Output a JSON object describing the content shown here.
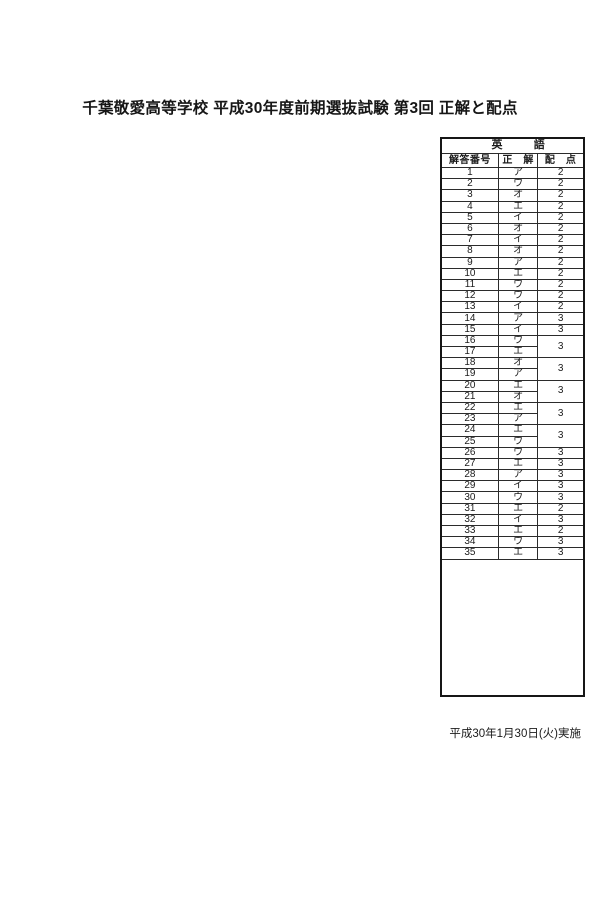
{
  "page": {
    "title": "千葉敬愛高等学校 平成30年度前期選抜試験 第3回 正解と配点",
    "footer_date": "平成30年1月30日(火)実施"
  },
  "colors": {
    "paper": "#ffffff",
    "ink": "#1b1b1b"
  },
  "answer_table": {
    "subject": {
      "left": "英",
      "right": "語"
    },
    "columns": [
      "解答番号",
      "正　解",
      "配　点"
    ],
    "rows": [
      {
        "no": "1",
        "answer": "ア",
        "points": "2",
        "points_rowspan": 1
      },
      {
        "no": "2",
        "answer": "ウ",
        "points": "2",
        "points_rowspan": 1
      },
      {
        "no": "3",
        "answer": "オ",
        "points": "2",
        "points_rowspan": 1
      },
      {
        "no": "4",
        "answer": "エ",
        "points": "2",
        "points_rowspan": 1
      },
      {
        "no": "5",
        "answer": "イ",
        "points": "2",
        "points_rowspan": 1
      },
      {
        "no": "6",
        "answer": "オ",
        "points": "2",
        "points_rowspan": 1
      },
      {
        "no": "7",
        "answer": "イ",
        "points": "2",
        "points_rowspan": 1
      },
      {
        "no": "8",
        "answer": "オ",
        "points": "2",
        "points_rowspan": 1
      },
      {
        "no": "9",
        "answer": "ア",
        "points": "2",
        "points_rowspan": 1
      },
      {
        "no": "10",
        "answer": "エ",
        "points": "2",
        "points_rowspan": 1
      },
      {
        "no": "11",
        "answer": "ウ",
        "points": "2",
        "points_rowspan": 1
      },
      {
        "no": "12",
        "answer": "ウ",
        "points": "2",
        "points_rowspan": 1
      },
      {
        "no": "13",
        "answer": "イ",
        "points": "2",
        "points_rowspan": 1
      },
      {
        "no": "14",
        "answer": "ア",
        "points": "3",
        "points_rowspan": 1
      },
      {
        "no": "15",
        "answer": "イ",
        "points": "3",
        "points_rowspan": 1
      },
      {
        "no": "16",
        "answer": "ウ",
        "points": "3",
        "points_rowspan": 2
      },
      {
        "no": "17",
        "answer": "エ",
        "points": null,
        "points_rowspan": 0
      },
      {
        "no": "18",
        "answer": "オ",
        "points": "3",
        "points_rowspan": 2
      },
      {
        "no": "19",
        "answer": "ア",
        "points": null,
        "points_rowspan": 0
      },
      {
        "no": "20",
        "answer": "エ",
        "points": "3",
        "points_rowspan": 2
      },
      {
        "no": "21",
        "answer": "オ",
        "points": null,
        "points_rowspan": 0
      },
      {
        "no": "22",
        "answer": "エ",
        "points": "3",
        "points_rowspan": 2
      },
      {
        "no": "23",
        "answer": "ア",
        "points": null,
        "points_rowspan": 0
      },
      {
        "no": "24",
        "answer": "エ",
        "points": "3",
        "points_rowspan": 2
      },
      {
        "no": "25",
        "answer": "ウ",
        "points": null,
        "points_rowspan": 0
      },
      {
        "no": "26",
        "answer": "ウ",
        "points": "3",
        "points_rowspan": 1
      },
      {
        "no": "27",
        "answer": "エ",
        "points": "3",
        "points_rowspan": 1
      },
      {
        "no": "28",
        "answer": "ア",
        "points": "3",
        "points_rowspan": 1
      },
      {
        "no": "29",
        "answer": "イ",
        "points": "3",
        "points_rowspan": 1
      },
      {
        "no": "30",
        "answer": "ウ",
        "points": "3",
        "points_rowspan": 1
      },
      {
        "no": "31",
        "answer": "エ",
        "points": "2",
        "points_rowspan": 1
      },
      {
        "no": "32",
        "answer": "イ",
        "points": "3",
        "points_rowspan": 1
      },
      {
        "no": "33",
        "answer": "エ",
        "points": "2",
        "points_rowspan": 1
      },
      {
        "no": "34",
        "answer": "ウ",
        "points": "3",
        "points_rowspan": 1
      },
      {
        "no": "35",
        "answer": "エ",
        "points": "3",
        "points_rowspan": 1
      }
    ]
  }
}
